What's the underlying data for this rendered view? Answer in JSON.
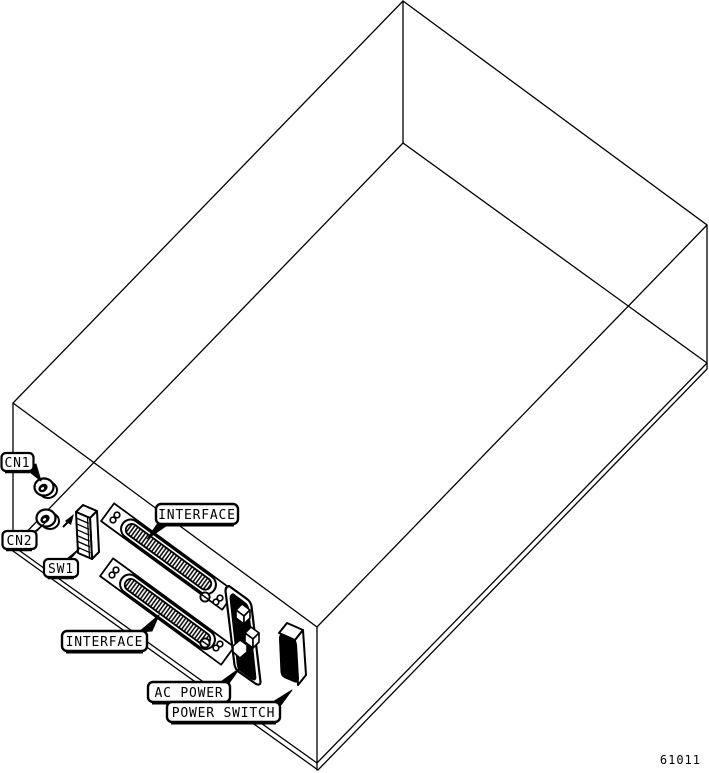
{
  "diagram": {
    "figure_number": "61011",
    "callouts": {
      "cn1": "CN1",
      "cn2": "CN2",
      "sw1": "SW1",
      "interface_top": "INTERFACE",
      "interface_bottom": "INTERFACE",
      "ac_power": "AC POWER",
      "power_switch": "POWER SWITCH"
    },
    "colors": {
      "line": "#000000",
      "background": "#ffffff"
    }
  }
}
